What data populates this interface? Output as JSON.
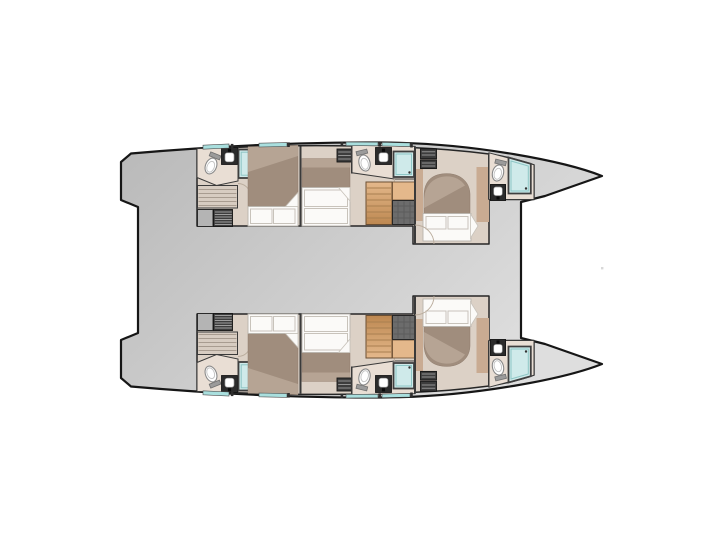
{
  "floorplan": {
    "vessel": "catamaran",
    "view": "lower-deck-plan",
    "orientation": "bow-right",
    "symmetry": "mirrored-hulls",
    "hulls": [
      {
        "id": "port-hull",
        "rooms": [
          "aft-cabin",
          "aft-bathroom",
          "aft-shower",
          "companionway-stairs",
          "storage-locker",
          "mid-cabin",
          "mid-bathroom",
          "mid-shower",
          "wood-stairs",
          "forward-cabin",
          "forward-bathroom",
          "forward-shower"
        ],
        "beds": 3,
        "toilets": 3,
        "sinks": 3,
        "showers": 3,
        "hull-windows": 4
      },
      {
        "id": "starboard-hull",
        "rooms": [
          "aft-cabin",
          "aft-bathroom",
          "aft-shower",
          "companionway-stairs",
          "storage-locker",
          "mid-cabin",
          "mid-bathroom",
          "mid-shower",
          "wood-stairs",
          "forward-cabin",
          "forward-bathroom",
          "forward-shower"
        ],
        "beds": 3,
        "toilets": 3,
        "sinks": 3,
        "showers": 3,
        "hull-windows": 4
      }
    ],
    "deck-areas": [
      "aft-platform",
      "bridge-deck",
      "bow-sections"
    ]
  },
  "colors": {
    "bg": "#ffffff",
    "deck-a": "#b9b9b9",
    "deck-b": "#dedede",
    "outline": "#161616",
    "wall": "#3a3a3a",
    "floor": "#dcd1c6",
    "floor-bath": "#e9ded4",
    "blanket": "#a08d7d",
    "blanket-light": "#bfae9e",
    "bed-white": "#fbfaf8",
    "cushion-line": "#c8c3bb",
    "stair-beige": "#d7ccc1",
    "stair-line": "#a89c90",
    "wood-a": "#e4b88b",
    "wood-b": "#bd8851",
    "wood-line": "#a97f50",
    "cabinet-dark": "#3d3d3d",
    "cabinet-slat": "#9d9d9d",
    "cabinet-gray": "#b4b4b4",
    "block-dark": "#6c6c6c",
    "block-line": "#595959",
    "glass": "#cfeaea",
    "glass-inner": "#8ec6c5",
    "frame": "#3f3f3f",
    "window": "#a9dfde",
    "porcelain": "#ffffff",
    "fixture-outline": "#8a8a8a",
    "sink-dark": "#2b2b2b",
    "trim-tan": "#c9ab92",
    "arc": "#b9ab9b",
    "artifact": "#d8d8d8"
  }
}
